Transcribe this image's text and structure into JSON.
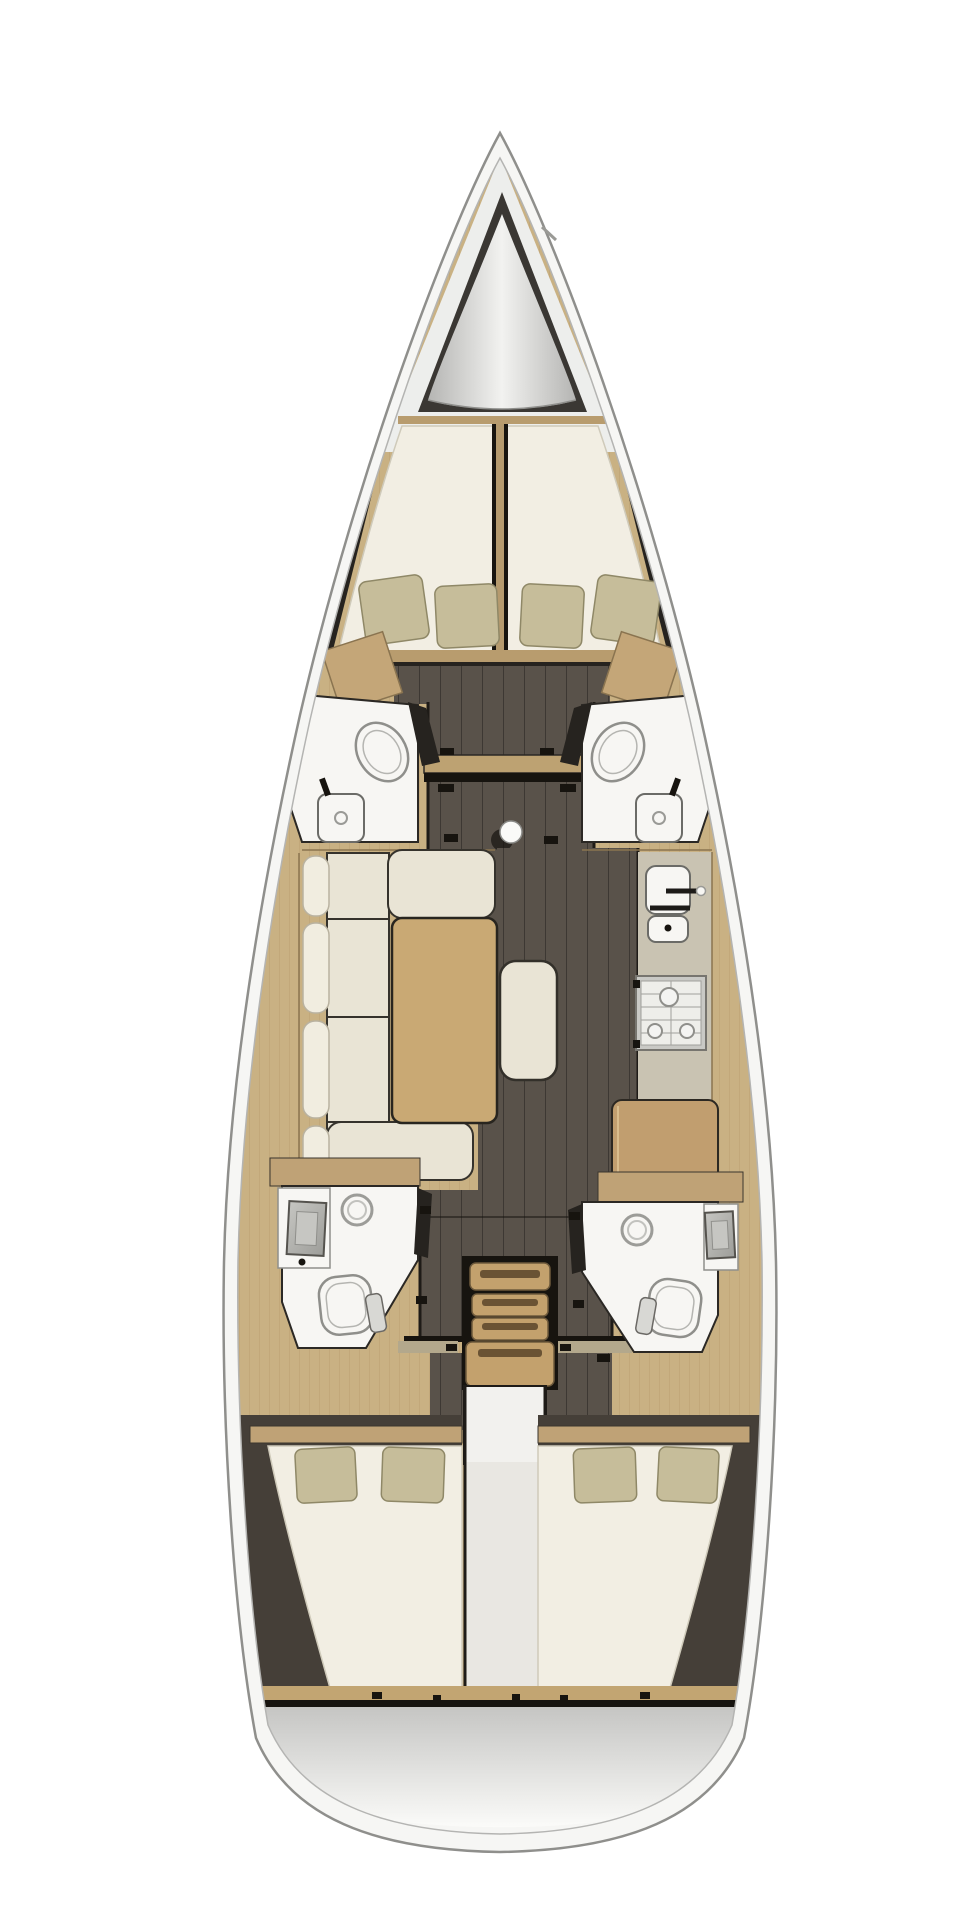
{
  "app": {
    "title": "Sailing yacht interior floor plan — top-down view",
    "description": "3D-rendered overhead layout of a sailboat: bow at top, stern at bottom, three cabins, four heads, saloon, galley and companionway"
  },
  "diagram": {
    "type": "boat-floor-plan",
    "orientation": {
      "bow": "top",
      "stern": "bottom",
      "port": "left",
      "starboard": "right"
    },
    "rooms": [
      {
        "id": "anchor-locker",
        "label": "Anchor locker (bow)"
      },
      {
        "id": "forward-cabin",
        "label": "Forward owner cabin — V-berth with 4 pillows"
      },
      {
        "id": "port-forward-head",
        "label": "Port forward head — toilet and washbasin"
      },
      {
        "id": "starboard-forward-head",
        "label": "Starboard forward head — toilet and washbasin"
      },
      {
        "id": "saloon",
        "label": "Saloon — U-shaped sofa, table and bench seat"
      },
      {
        "id": "galley",
        "label": "Starboard galley — double sink and 3-burner stove"
      },
      {
        "id": "nav-station",
        "label": "Chart / navigation desk"
      },
      {
        "id": "companionway",
        "label": "Companionway ladder with 4 treads"
      },
      {
        "id": "port-aft-head",
        "label": "Port aft head — shower, washbasin, toilet"
      },
      {
        "id": "starboard-aft-head",
        "label": "Starboard aft head — shower, washbasin, toilet"
      },
      {
        "id": "port-aft-cabin",
        "label": "Port aft double cabin — 2 pillows"
      },
      {
        "id": "starboard-aft-cabin",
        "label": "Starboard aft double cabin — 2 pillows"
      },
      {
        "id": "transom",
        "label": "Stern / transom platform"
      }
    ],
    "fixtures": {
      "toilets": 4,
      "washbasins": 6,
      "showers": 2,
      "stove_burners": 3,
      "berths": 3,
      "pillows": 8,
      "stair_treads": 4,
      "mast": 1,
      "saloon_table": 1,
      "ottoman_bench": 1
    },
    "palette": {
      "hull_fill": "#f6f6f4",
      "hull_outline": "#8f8f8c",
      "hull_inner_line": "#b4b4b2",
      "deck_white": "#edeeec",
      "cone_dark": "#3a3733",
      "cone_light": "#f2f2f0",
      "cone_edge": "#b5b5b3",
      "wood_base": "#c9b183",
      "wood_grain": "#a8895c",
      "wood_cabinet": "#c4a678",
      "wood_table": "#c9a974",
      "wood_desk": "#c19e6f",
      "wood_stairs": "#c3a16d",
      "stairs_slot": "#6a5334",
      "wood_beam": "#bda272",
      "wood_sill": "#c2a572",
      "wood_wall": "#bfa276",
      "wood_divider": "#b59a6e",
      "wood_foot_sill": "#b89c6e",
      "threshold": "#b3a88c",
      "floor": "#59524a",
      "plank_line": "#3d3833",
      "dark_trim": "#26231f",
      "shadow_black": "#17140f",
      "mattress": "#f2eee3",
      "mattress_edge": "#cfcaba",
      "pillow": "#c6bd9a",
      "pillow_edge": "#8f8867",
      "cushion": "#e9e4d5",
      "bolster": "#f1ede0",
      "cushion_line": "#35322c",
      "counter": "#c9c3b2",
      "fixture_white": "#f7f6f3",
      "fixture_line": "#8f8f8b",
      "steel_dark": "#9d9d99",
      "steel_light": "#c6c6c2",
      "engine_strip": "#e9e7e2",
      "engine_panel": "#f2f1ee",
      "brown_berth": "#453f38",
      "transom_top": "#c5c5c3",
      "transom_bottom": "#fbfbf9",
      "mast_fill": "#fafaf8"
    }
  }
}
